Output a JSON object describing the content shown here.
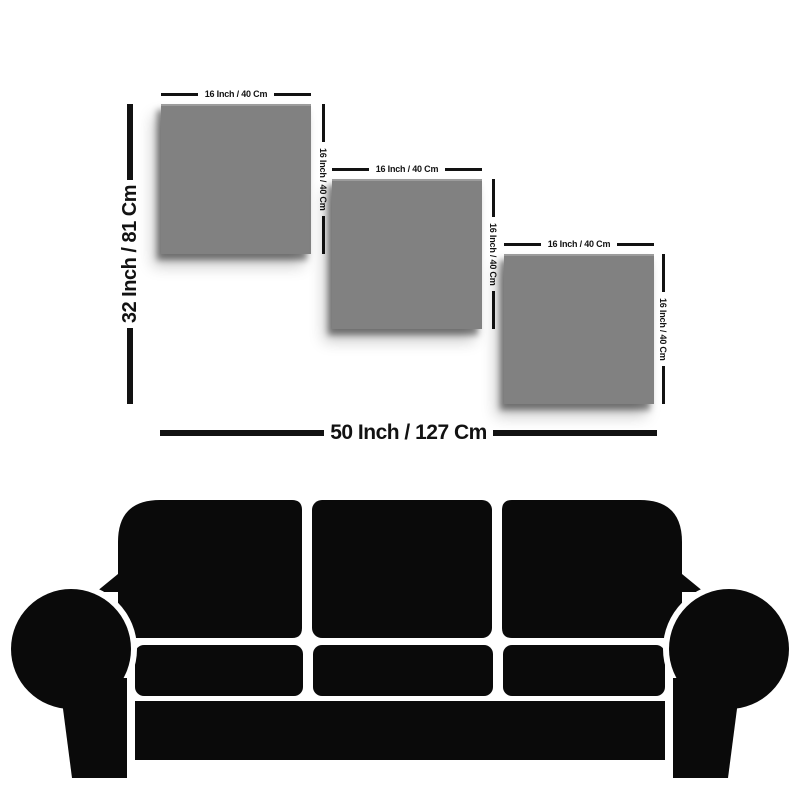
{
  "background_color": "#ffffff",
  "size_guide": {
    "panel_color": "#818181",
    "dimension_color": "#121212",
    "panels": [
      {
        "name": "panel-1",
        "width_label": "16 Inch / 40 Cm",
        "height_label": "16 Inch / 40 Cm"
      },
      {
        "name": "panel-2",
        "width_label": "16 Inch / 40 Cm",
        "height_label": "16 Inch / 40 Cm"
      },
      {
        "name": "panel-3",
        "width_label": "16 Inch / 40 Cm",
        "height_label": "16 Inch / 40 Cm"
      }
    ],
    "overall_height_label": "32 Inch / 81 Cm",
    "overall_width_label": "50 Inch / 127 Cm"
  },
  "furniture": {
    "icon": "sofa-silhouette",
    "color": "#0a0a0a"
  }
}
